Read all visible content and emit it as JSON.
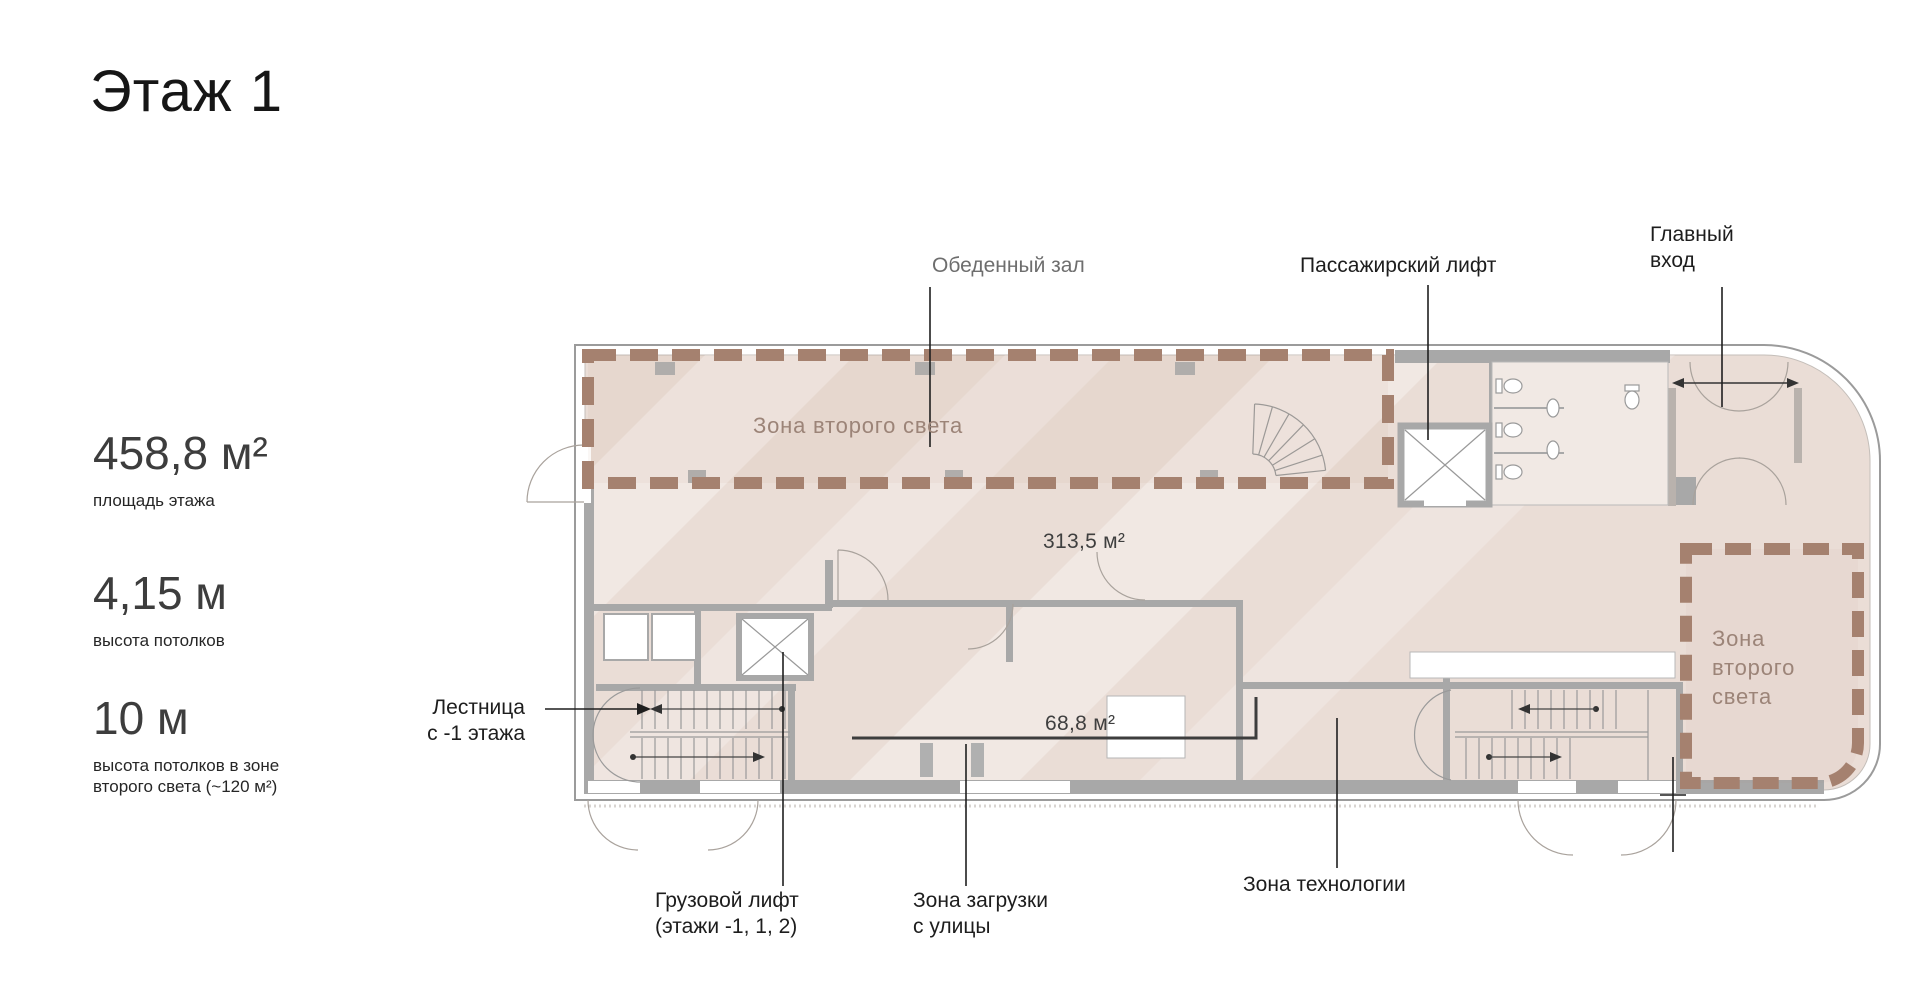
{
  "page_title": "Этаж 1",
  "stats": [
    {
      "value": "458,8 м²",
      "caption_lines": [
        "площадь этажа"
      ]
    },
    {
      "value": "4,15 м",
      "caption_lines": [
        "высота потолков"
      ]
    },
    {
      "value": "10 м",
      "caption_lines": [
        "высота потолков в зоне",
        "второго света (~120 м²)"
      ]
    }
  ],
  "plan": {
    "room_labels": {
      "dining_hall": "Обеденный зал",
      "passenger_lift": "Пассажирский лифт",
      "main_entrance": [
        "Главный",
        "вход"
      ],
      "stairs_from_minus1": [
        "Лестница",
        "с -1 этажа"
      ],
      "freight_lift": [
        "Грузовой лифт",
        "(этажи -1, 1, 2)"
      ],
      "loading_zone": [
        "Зона загрузки",
        "с улицы"
      ],
      "technology_zone": "Зона технологии"
    },
    "zones": {
      "second_light_left": "Зона второго света",
      "second_light_right": [
        "Зона",
        "второго",
        "света"
      ]
    },
    "areas": {
      "main_hall": "313,5 м²",
      "service": "68,8 м²"
    },
    "colors": {
      "zone_dash": "#a5816f",
      "zone_text": "#9c8478",
      "floor_fill": "#eaddd6",
      "wall_gray": "#a8a8a8",
      "leader_line": "#1f1f1f"
    }
  }
}
